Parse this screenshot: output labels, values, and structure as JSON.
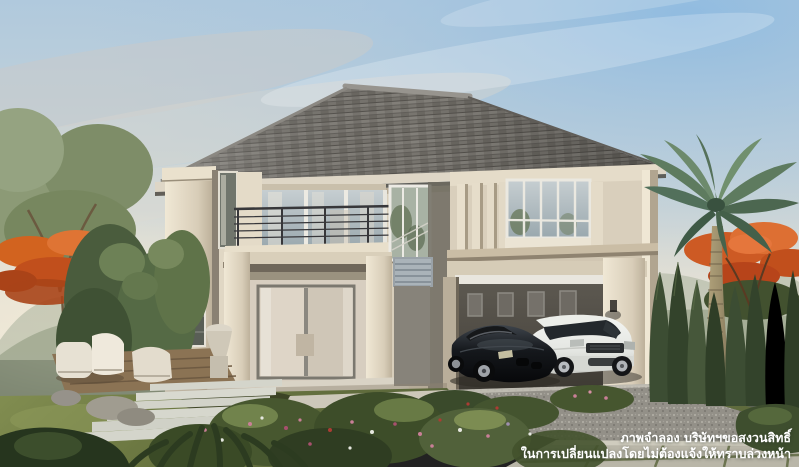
{
  "scene": {
    "type": "architectural-rendering",
    "subject": "Two-storey cream detached house with balcony, carport with black coupe and white SUV, tropical garden, palm tree and flame trees",
    "lighting": "late-afternoon warm sunlight from the left"
  },
  "disclaimer": {
    "line1": "ภาพจำลอง บริษัทฯขอสงวนสิทธิ์",
    "line2": "ในการเปลี่ยนแปลงโดยไม่ต้องแจ้งให้ทราบล่วงหน้า",
    "color": "#ffffff"
  },
  "objects": [
    "hip tiled roof",
    "second-floor balcony with dark metal railing",
    "sliding glass doors with sheer curtains",
    "stairwell window",
    "carport with framed wall art",
    "black sports coupe",
    "white SUV",
    "gravel driveway",
    "stepping-stone path",
    "timber deck with cream lounge chairs",
    "stone planter",
    "palm tree",
    "orange flame trees",
    "conifer hedge",
    "flowering shrubs",
    "lawn",
    "stone pavers"
  ],
  "palette": {
    "sky_blue": "#a9c7e2",
    "sky_haze": "#e7e3d8",
    "roof": "#75726d",
    "wall_cream": "#d8cfbd",
    "wall_sunlit": "#efe8d6",
    "wall_shade": "#b2a793",
    "foliage_dark": "#3c4c31",
    "foliage_mid": "#5d6f49",
    "foliage_light": "#8a9a74",
    "flame_orange": "#d45f24",
    "lawn": "#6e7a46",
    "gravel": "#94918a",
    "car_black": "#14161a",
    "car_white": "#ebedea",
    "palm_trunk": "#a5966f",
    "railing": "#37373a",
    "text": "#ffffff"
  }
}
